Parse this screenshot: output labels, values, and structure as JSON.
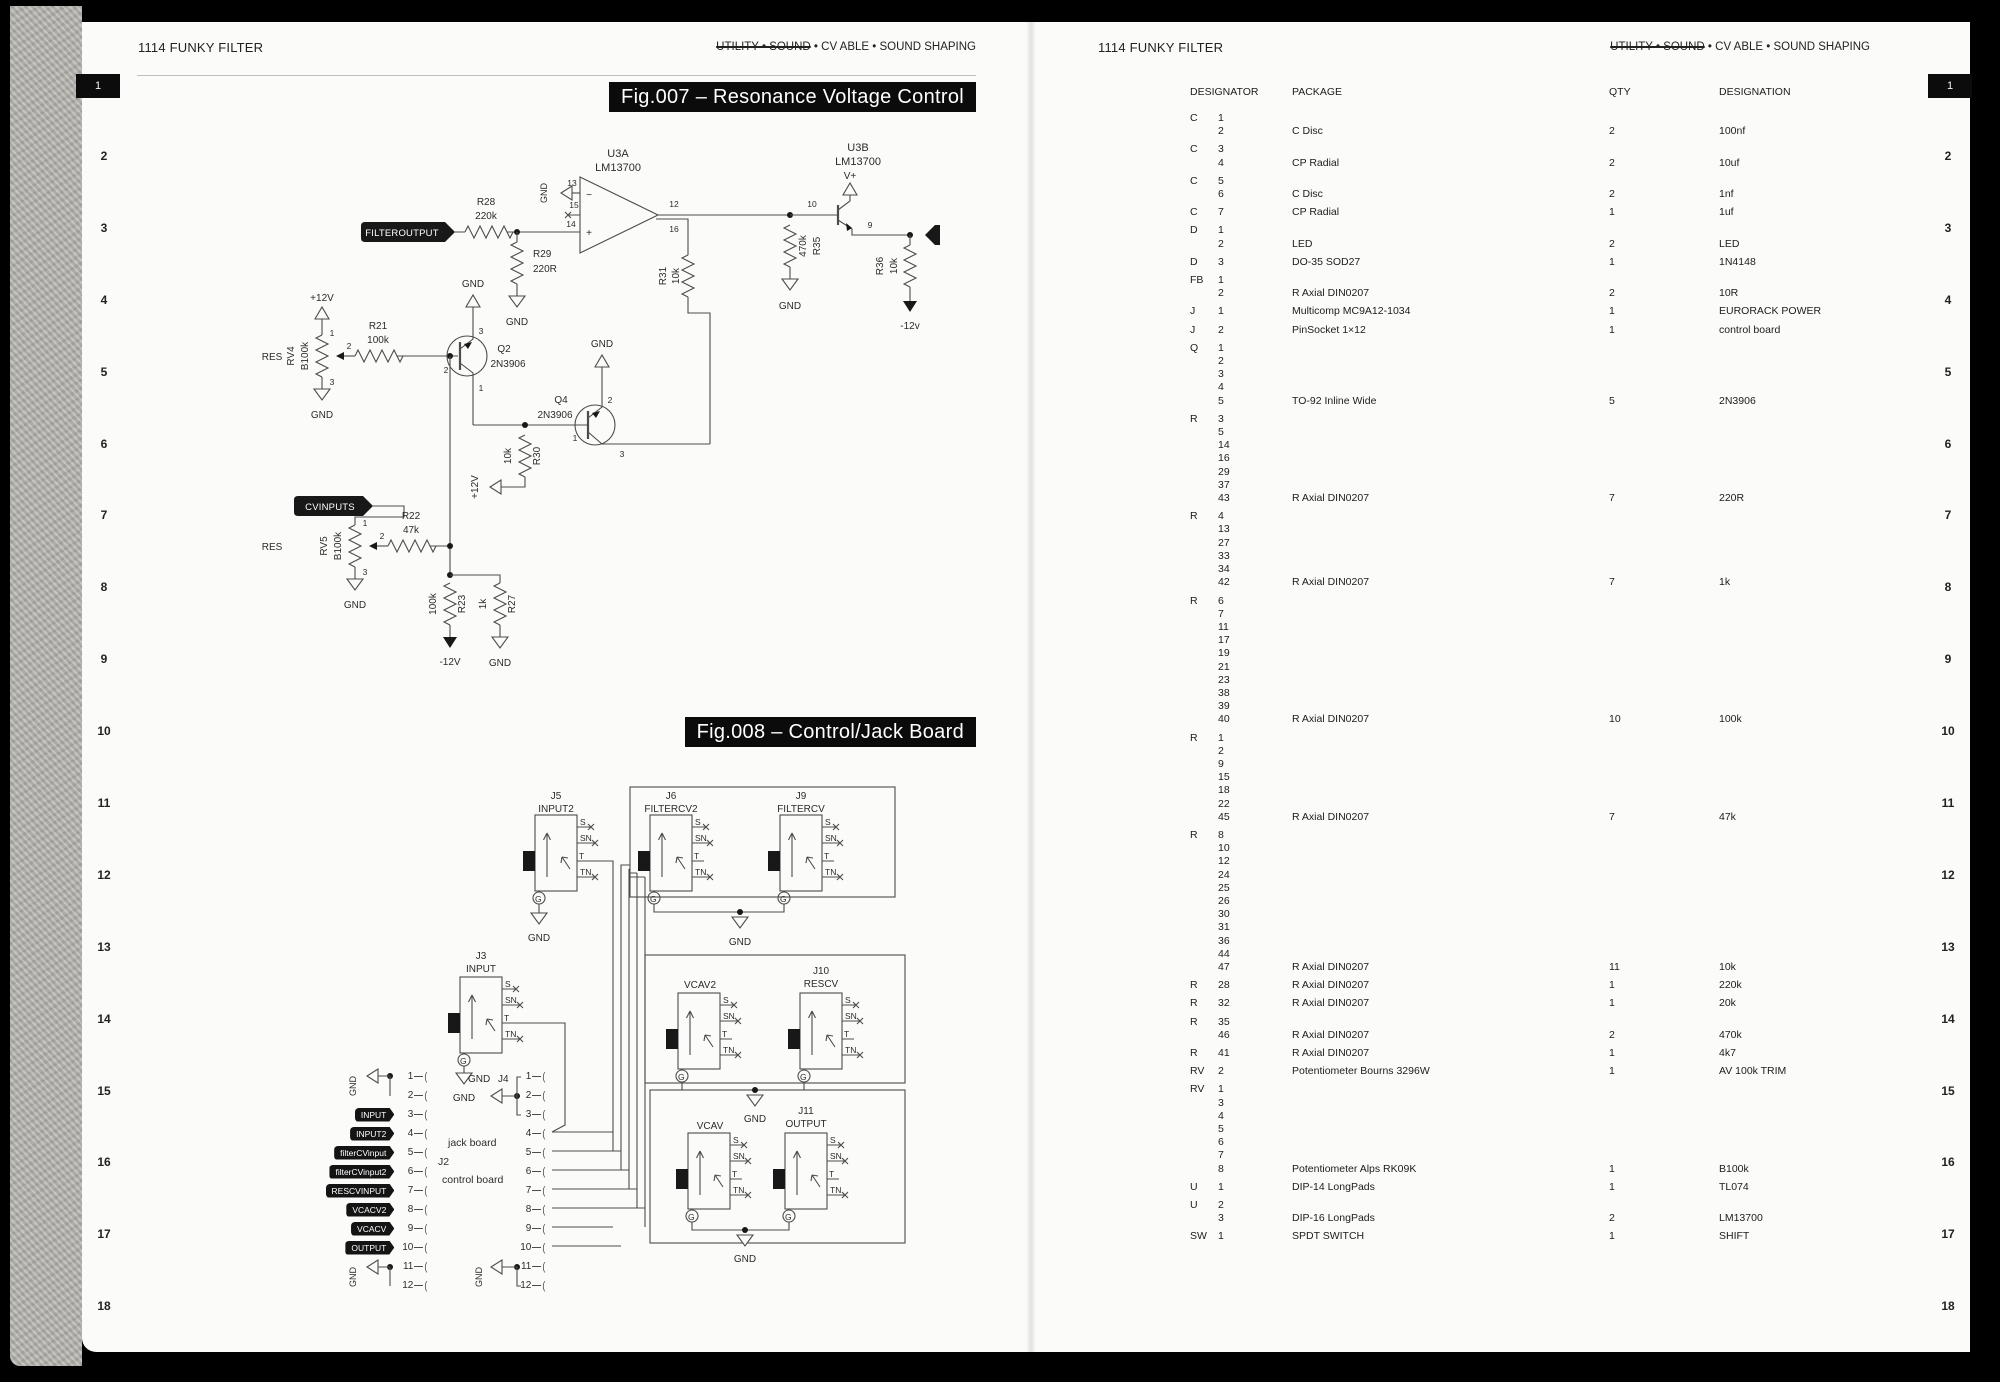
{
  "page_left": {
    "header_left": "1114 FUNKY FILTER",
    "header_right_struck": "UTILITY • SOUND",
    "header_right_rest": " • CV ABLE • SOUND SHAPING",
    "fig007_title": "Fig.007 – Resonance Voltage Control",
    "fig008_title": "Fig.008 – Control/Jack Board"
  },
  "page_right": {
    "header_left": "1114 FUNKY FILTER",
    "header_right_struck": "UTILITY • SOUND",
    "header_right_rest": " • CV ABLE • SOUND SHAPING"
  },
  "margin_first": "1",
  "margin_rest": [
    "2",
    "3",
    "4",
    "5",
    "6",
    "7",
    "8",
    "9",
    "10",
    "11",
    "12",
    "13",
    "14",
    "15",
    "16",
    "17",
    "18"
  ],
  "lbl": {
    "gnd": "GND",
    "p12": "+12V",
    "n12": "-12V",
    "n12v": "-12v",
    "vplus": "V+",
    "res": "RES"
  },
  "fig007": {
    "tags": {
      "filteroutput": "FILTEROUTPUT",
      "resinput": "RESINPUT",
      "cvinputs": "CVINPUTS"
    },
    "u3a": {
      "ref": "U3A",
      "part": "LM13700",
      "p13": "13",
      "p15": "15",
      "p14": "14",
      "p12": "12",
      "p16": "16",
      "minus": "−",
      "plus": "+"
    },
    "u3b": {
      "ref": "U3B",
      "part": "LM13700",
      "p10": "10",
      "p9": "9"
    },
    "r28": {
      "r": "R28",
      "v": "220k"
    },
    "r29": {
      "r": "R29",
      "v": "220R"
    },
    "r31": {
      "r": "R31",
      "v": "10k"
    },
    "r35": {
      "r": "R35",
      "v": "470k"
    },
    "r36": {
      "r": "R36",
      "v": "10k"
    },
    "r21": {
      "r": "R21",
      "v": "100k"
    },
    "r22": {
      "r": "R22",
      "v": "47k"
    },
    "r23": {
      "r": "R23",
      "v": "100k"
    },
    "r27": {
      "r": "R27",
      "v": "1k"
    },
    "r30": {
      "r": "R30",
      "v": "10k"
    },
    "rv4": {
      "r": "RV4",
      "v": "B100k",
      "p1": "1",
      "p2": "2",
      "p3": "3"
    },
    "rv5": {
      "r": "RV5",
      "v": "B100k",
      "p1": "1",
      "p2": "2",
      "p3": "3"
    },
    "q2": {
      "r": "Q2",
      "part": "2N3906",
      "p1": "1",
      "p2": "2",
      "p3": "3"
    },
    "q4": {
      "r": "Q4",
      "part": "2N3906",
      "p1": "1",
      "p2": "2",
      "p3": "3"
    }
  },
  "fig008": {
    "pins": {
      "s": "S",
      "sn": "SN",
      "t": "T",
      "tn": "TN",
      "g": "G"
    },
    "jacks": {
      "j5": {
        "ref": "J5",
        "name": "INPUT2"
      },
      "j6": {
        "ref": "J6",
        "name": "FILTERCV2"
      },
      "j9": {
        "ref": "J9",
        "name": "FILTERCV"
      },
      "j3": {
        "ref": "J3",
        "name": "INPUT"
      },
      "vcav2": {
        "name": "VCAV2"
      },
      "j10": {
        "ref": "J10",
        "name": "RESCV"
      },
      "vcav": {
        "name": "VCAV"
      },
      "j11": {
        "ref": "J11",
        "name": "OUTPUT"
      }
    },
    "j2": {
      "ref": "J2",
      "board": "control board"
    },
    "j4": {
      "ref": "J4",
      "board": "jack board"
    },
    "j2_pins": [
      {
        "n": "1",
        "tag": ""
      },
      {
        "n": "2",
        "tag": ""
      },
      {
        "n": "3",
        "tag": "INPUT"
      },
      {
        "n": "4",
        "tag": "INPUT2"
      },
      {
        "n": "5",
        "tag": "filterCVinput"
      },
      {
        "n": "6",
        "tag": "filterCVinput2"
      },
      {
        "n": "7",
        "tag": "RESCVINPUT"
      },
      {
        "n": "8",
        "tag": "VCACV2"
      },
      {
        "n": "9",
        "tag": "VCACV"
      },
      {
        "n": "10",
        "tag": "OUTPUT"
      },
      {
        "n": "11",
        "tag": ""
      },
      {
        "n": "12",
        "tag": ""
      }
    ],
    "j4_pins": [
      "1",
      "2",
      "3",
      "4",
      "5",
      "6",
      "7",
      "8",
      "9",
      "10",
      "11",
      "12"
    ]
  },
  "bom": {
    "headers": [
      "DESIGNATOR",
      "PACKAGE",
      "QTY",
      "DESIGNATION"
    ],
    "rows": [
      {
        "prefix": "C",
        "numbers": [
          "1",
          "2"
        ],
        "package": "C Disc",
        "qty": "2",
        "designation": "100nf"
      },
      {
        "prefix": "C",
        "numbers": [
          "3",
          "4"
        ],
        "package": "CP Radial",
        "qty": "2",
        "designation": "10uf"
      },
      {
        "prefix": "C",
        "numbers": [
          "5",
          "6"
        ],
        "package": "C Disc",
        "qty": "2",
        "designation": "1nf"
      },
      {
        "prefix": "C",
        "numbers": [
          "7"
        ],
        "package": "CP Radial",
        "qty": "1",
        "designation": "1uf"
      },
      {
        "prefix": "D",
        "numbers": [
          "1",
          "2"
        ],
        "package": "LED",
        "qty": "2",
        "designation": "LED"
      },
      {
        "prefix": "D",
        "numbers": [
          "3"
        ],
        "package": "DO-35 SOD27",
        "qty": "1",
        "designation": "1N4148"
      },
      {
        "prefix": "FB",
        "numbers": [
          "1",
          "2"
        ],
        "package": "R Axial DIN0207",
        "qty": "2",
        "designation": "10R"
      },
      {
        "prefix": "J",
        "numbers": [
          "1"
        ],
        "package": "Multicomp MC9A12-1034",
        "qty": "1",
        "designation": "EURORACK POWER"
      },
      {
        "prefix": "J",
        "numbers": [
          "2"
        ],
        "package": "PinSocket 1×12",
        "qty": "1",
        "designation": "control board"
      },
      {
        "prefix": "Q",
        "numbers": [
          "1",
          "2",
          "3",
          "4",
          "5"
        ],
        "package": "TO-92 Inline Wide",
        "qty": "5",
        "designation": "2N3906"
      },
      {
        "prefix": "R",
        "numbers": [
          "3",
          "5",
          "14",
          "16",
          "29",
          "37",
          "43"
        ],
        "package": "R Axial DIN0207",
        "qty": "7",
        "designation": "220R"
      },
      {
        "prefix": "R",
        "numbers": [
          "4",
          "13",
          "27",
          "33",
          "34",
          "42"
        ],
        "package": "R Axial DIN0207",
        "qty": "7",
        "designation": "1k"
      },
      {
        "prefix": "R",
        "numbers": [
          "6",
          "7",
          "11",
          "17",
          "19",
          "21",
          "23",
          "38",
          "39",
          "40"
        ],
        "package": "R Axial DIN0207",
        "qty": "10",
        "designation": "100k"
      },
      {
        "prefix": "R",
        "numbers": [
          "1",
          "2",
          "9",
          "15",
          "18",
          "22",
          "45"
        ],
        "package": "R Axial DIN0207",
        "qty": "7",
        "designation": "47k"
      },
      {
        "prefix": "R",
        "numbers": [
          "8",
          "10",
          "12",
          "24",
          "25",
          "26",
          "30",
          "31",
          "36",
          "44",
          "47"
        ],
        "package": "R Axial DIN0207",
        "qty": "11",
        "designation": "10k"
      },
      {
        "prefix": "R",
        "numbers": [
          "28"
        ],
        "package": "R Axial DIN0207",
        "qty": "1",
        "designation": "220k"
      },
      {
        "prefix": "R",
        "numbers": [
          "32"
        ],
        "package": "R Axial DIN0207",
        "qty": "1",
        "designation": "20k"
      },
      {
        "prefix": "R",
        "numbers": [
          "35",
          "46"
        ],
        "package": "R Axial DIN0207",
        "qty": "2",
        "designation": "470k"
      },
      {
        "prefix": "R",
        "numbers": [
          "41"
        ],
        "package": "R Axial DIN0207",
        "qty": "1",
        "designation": "4k7"
      },
      {
        "prefix": "RV",
        "numbers": [
          "2"
        ],
        "package": "Potentiometer Bourns 3296W",
        "qty": "1",
        "designation": "AV 100k TRIM"
      },
      {
        "prefix": "RV",
        "numbers": [
          "1",
          "3",
          "4",
          "5",
          "6",
          "7",
          "8"
        ],
        "package": "Potentiometer Alps RK09K",
        "qty": "1",
        "designation": "B100k"
      },
      {
        "prefix": "U",
        "numbers": [
          "1"
        ],
        "package": "DIP-14 LongPads",
        "qty": "1",
        "designation": "TL074"
      },
      {
        "prefix": "U",
        "numbers": [
          "2",
          "3"
        ],
        "package": "DIP-16 LongPads",
        "qty": "2",
        "designation": "LM13700"
      },
      {
        "prefix": "SW",
        "numbers": [
          "1"
        ],
        "package": "SPDT SWITCH",
        "qty": "1",
        "designation": "SHIFT"
      }
    ]
  }
}
